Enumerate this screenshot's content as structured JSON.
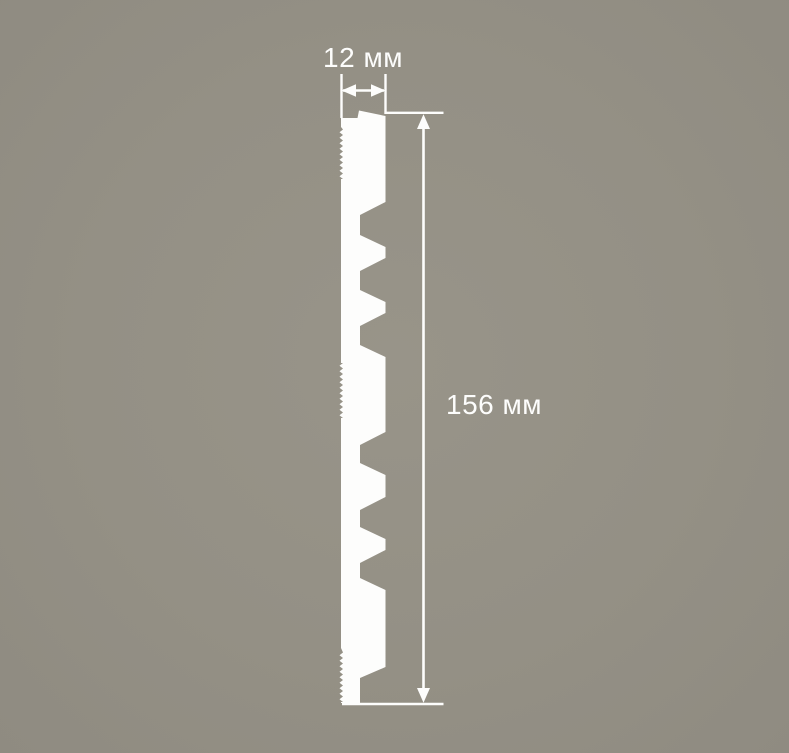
{
  "figure": {
    "background_color": "#949085",
    "background_center": "#989489",
    "background_edge": "#8f8b81",
    "line_color": "#fdfdfc",
    "width_dimension": {
      "label": "12 мм"
    },
    "height_dimension": {
      "label": "156 мм"
    }
  },
  "geometry": {
    "profile": {
      "x_left": 341,
      "x_right": 385.5,
      "x_notch": 360,
      "top_left_y": 118,
      "tab_x": 357.5,
      "tab_top_y": 110.5,
      "top_right_y": 116,
      "notches": [
        [
          202,
          215,
          235,
          247
        ],
        [
          258,
          271,
          290,
          302
        ],
        [
          313,
          326,
          345,
          357
        ],
        [
          432,
          445,
          463,
          475
        ],
        [
          497,
          510,
          527,
          539
        ],
        [
          550,
          563,
          578,
          590
        ]
      ],
      "taper_top_y": 667,
      "taper_knee_y": 678,
      "bottom_y": 703,
      "serrations": [
        [
          127,
          179
        ],
        [
          363,
          418
        ],
        [
          648,
          702
        ]
      ],
      "serration_period": 5.5,
      "serration_out": 339.5,
      "serration_base": 343
    }
  }
}
